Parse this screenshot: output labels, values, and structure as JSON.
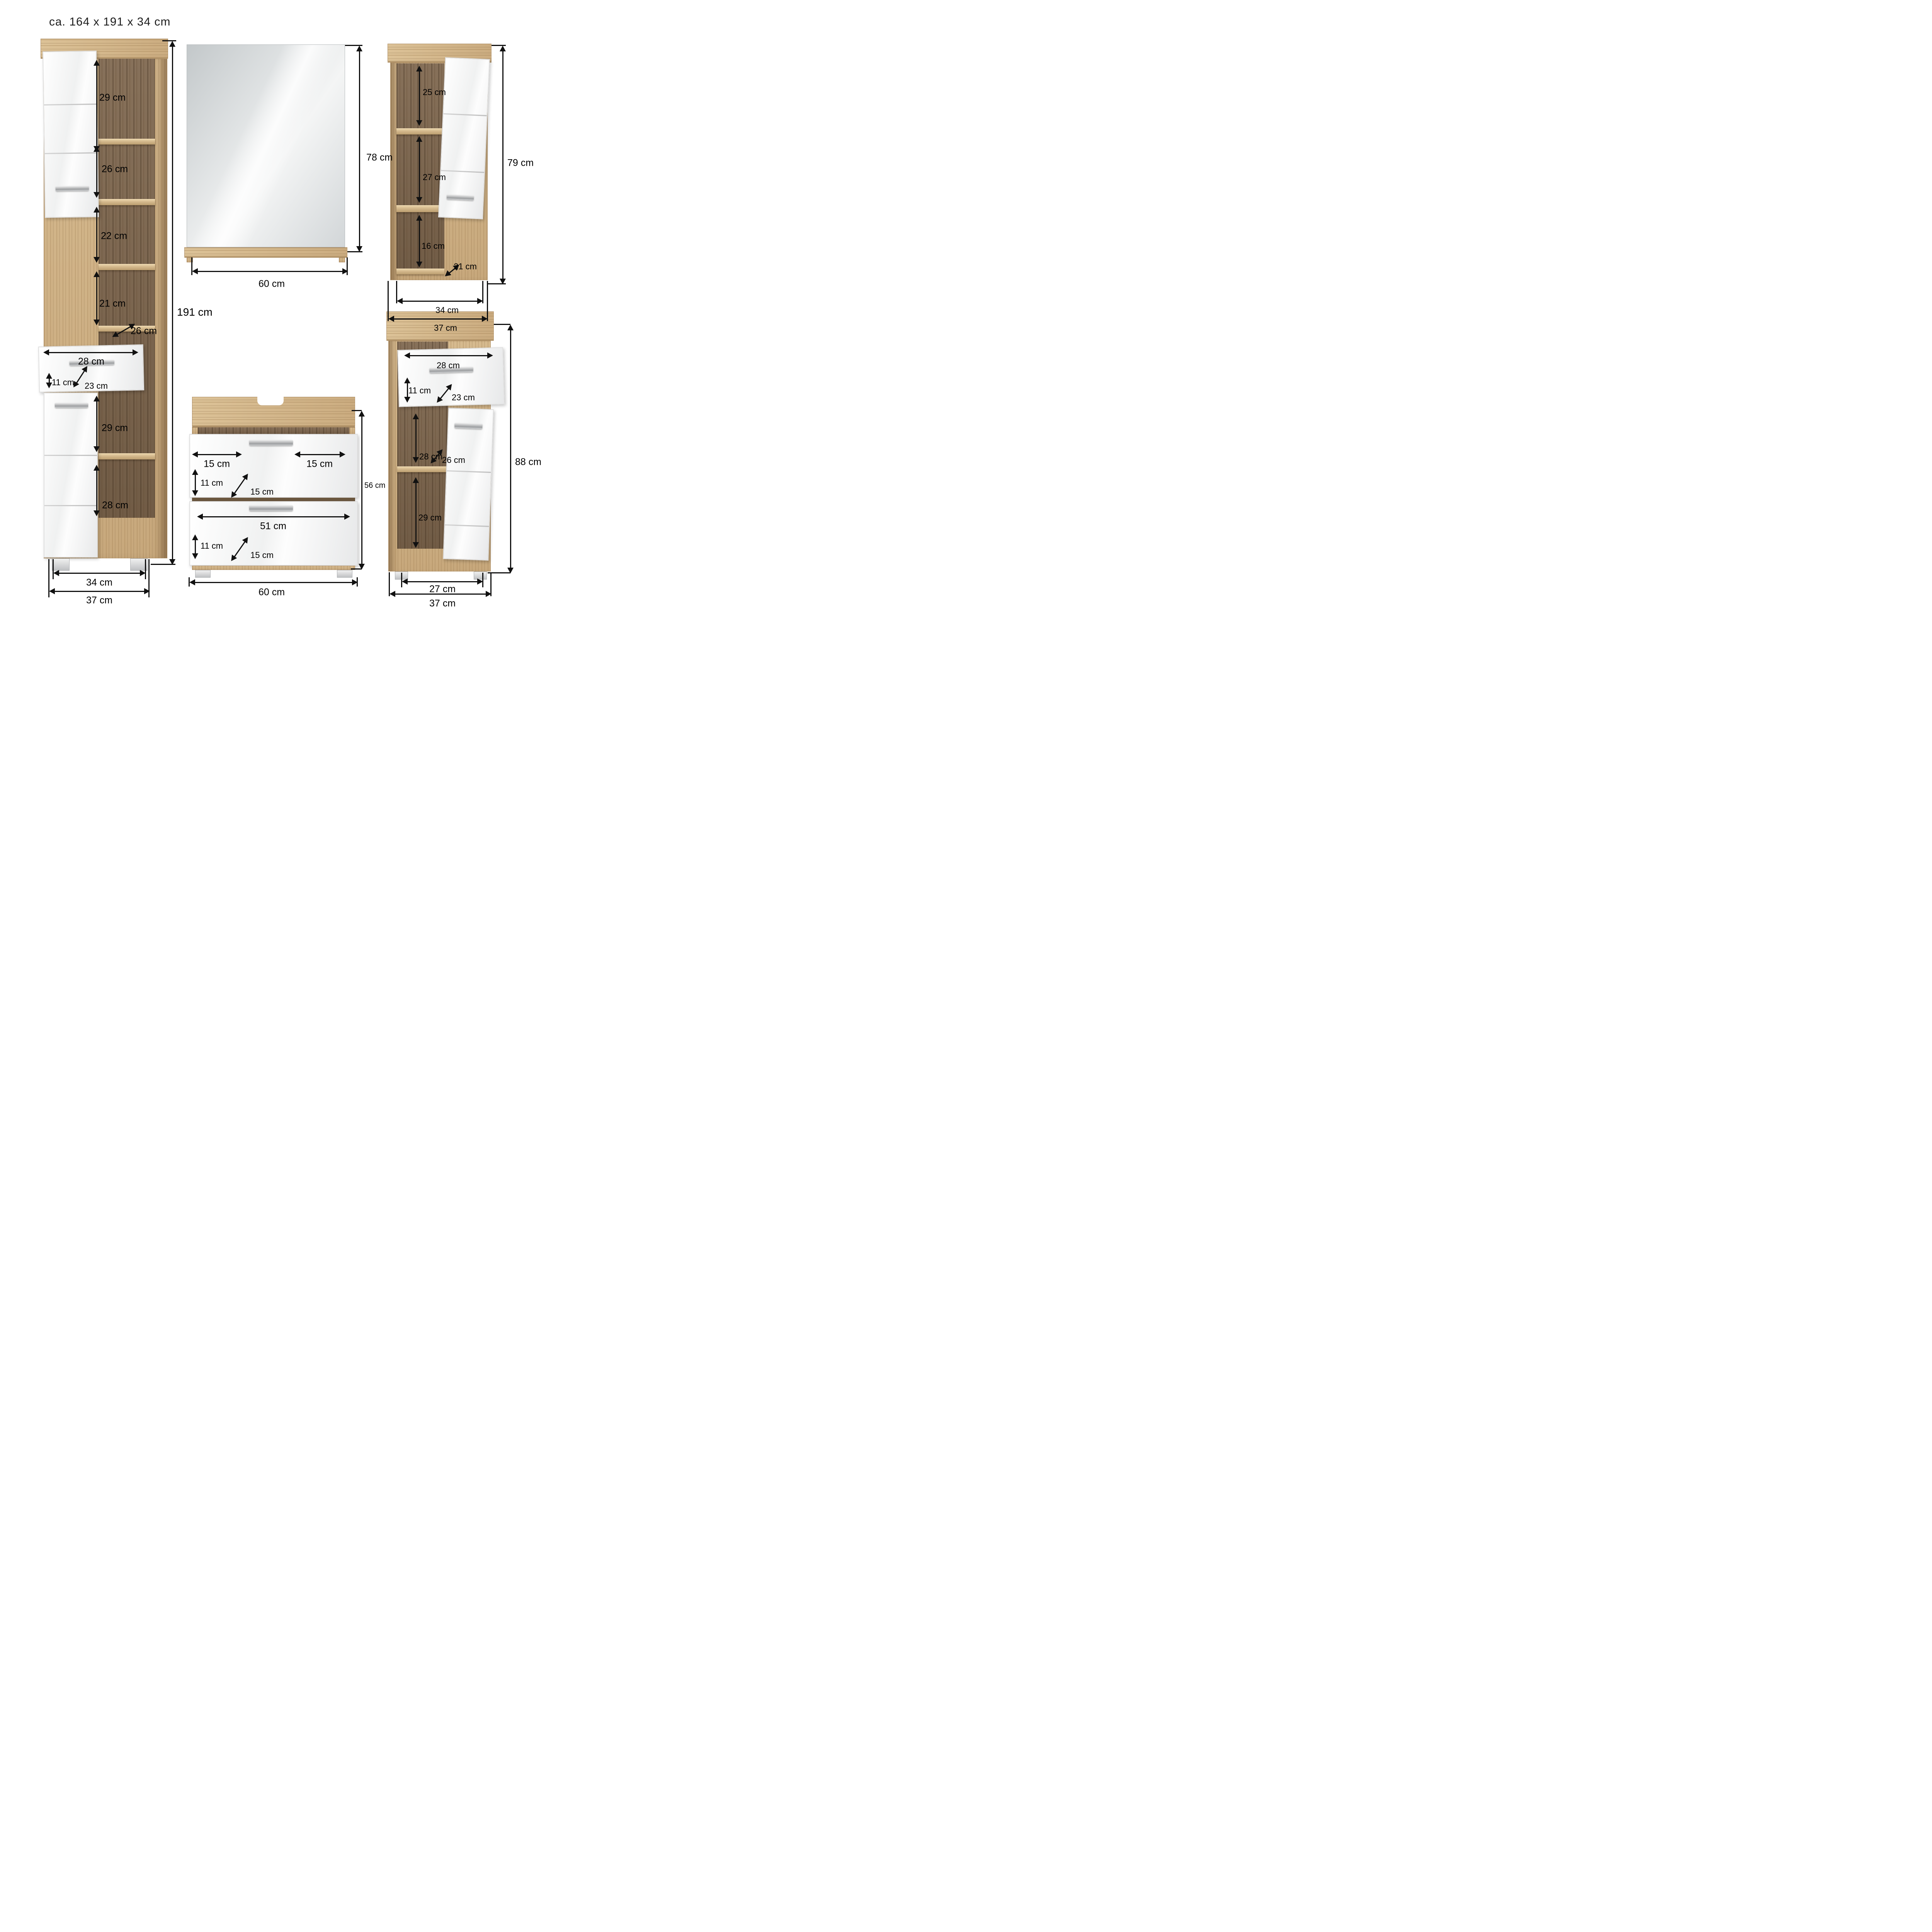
{
  "title": "ca. 164 x 191 x 34 cm",
  "tall_cabinet": {
    "compartment_1_height": "29 cm",
    "compartment_2_height": "26 cm",
    "compartment_3_height": "22 cm",
    "compartment_4_height": "21 cm",
    "shelf_depth": "26 cm",
    "drawer_width": "28 cm",
    "drawer_front_height": "11 cm",
    "drawer_depth": "23 cm",
    "compartment_5_height": "29 cm",
    "compartment_6_height": "28 cm",
    "feet_span_width": "34 cm",
    "total_width": "37 cm",
    "total_height": "191 cm"
  },
  "mirror": {
    "total_height": "78 cm",
    "total_width": "60 cm"
  },
  "wall_cabinet": {
    "compartment_1_height": "25 cm",
    "compartment_2_height": "27 cm",
    "compartment_3_height": "16 cm",
    "inner_depth": "21 cm",
    "total_height": "79 cm",
    "inner_width": "34 cm",
    "total_width": "37 cm"
  },
  "washbasin_cabinet": {
    "front_left_width": "15 cm",
    "front_right_width": "15 cm",
    "front_1_height": "11 cm",
    "front_1_depth": "15 cm",
    "front_2_width": "51 cm",
    "front_2_height": "11 cm",
    "front_2_depth": "15 cm",
    "total_width": "60 cm",
    "total_height": "56 cm"
  },
  "side_cabinet": {
    "drawer_width": "28 cm",
    "drawer_front_height": "11 cm",
    "drawer_depth": "23 cm",
    "compartment_1_height": "28 cm",
    "shelf_depth": "26 cm",
    "compartment_2_height": "29 cm",
    "feet_span_width": "27 cm",
    "total_width": "37 cm",
    "total_height": "88 cm"
  }
}
